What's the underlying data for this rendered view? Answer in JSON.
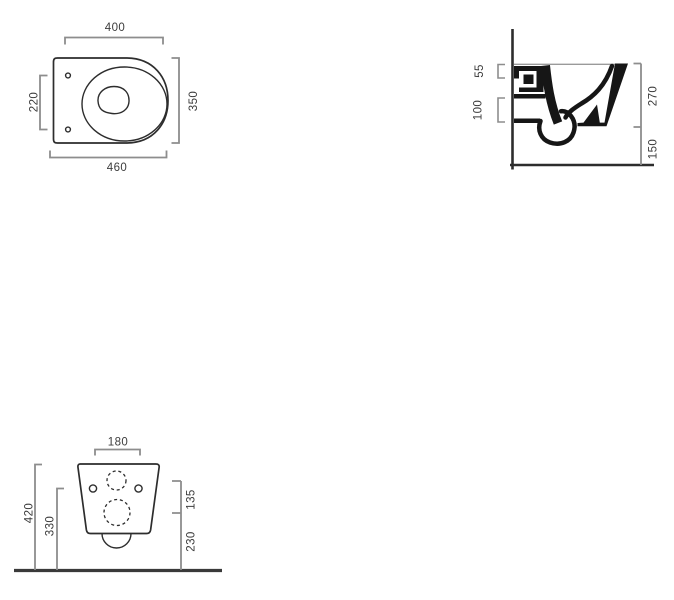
{
  "top_view": {
    "dim_length_top": "400",
    "dim_length_overall": "460",
    "dim_width_overall": "350",
    "dim_fixing_hole_spacing": "220"
  },
  "side_view": {
    "dim_water_inlet": "55",
    "dim_waste_outlet": "100",
    "dim_body_height": "270",
    "dim_underside_clearance": "150"
  },
  "rear_view": {
    "dim_inlet_offset_width": "180",
    "dim_overall_height": "420",
    "dim_fixing_holes_height": "330",
    "dim_inlet_to_outlet": "135",
    "dim_outlet_height": "230"
  },
  "colors": {
    "dimension_line": "#8d8d8d",
    "outline": "#2d2d2d",
    "fill_black": "#161616",
    "label_text": "#3c3c3c",
    "background": "#ffffff"
  }
}
